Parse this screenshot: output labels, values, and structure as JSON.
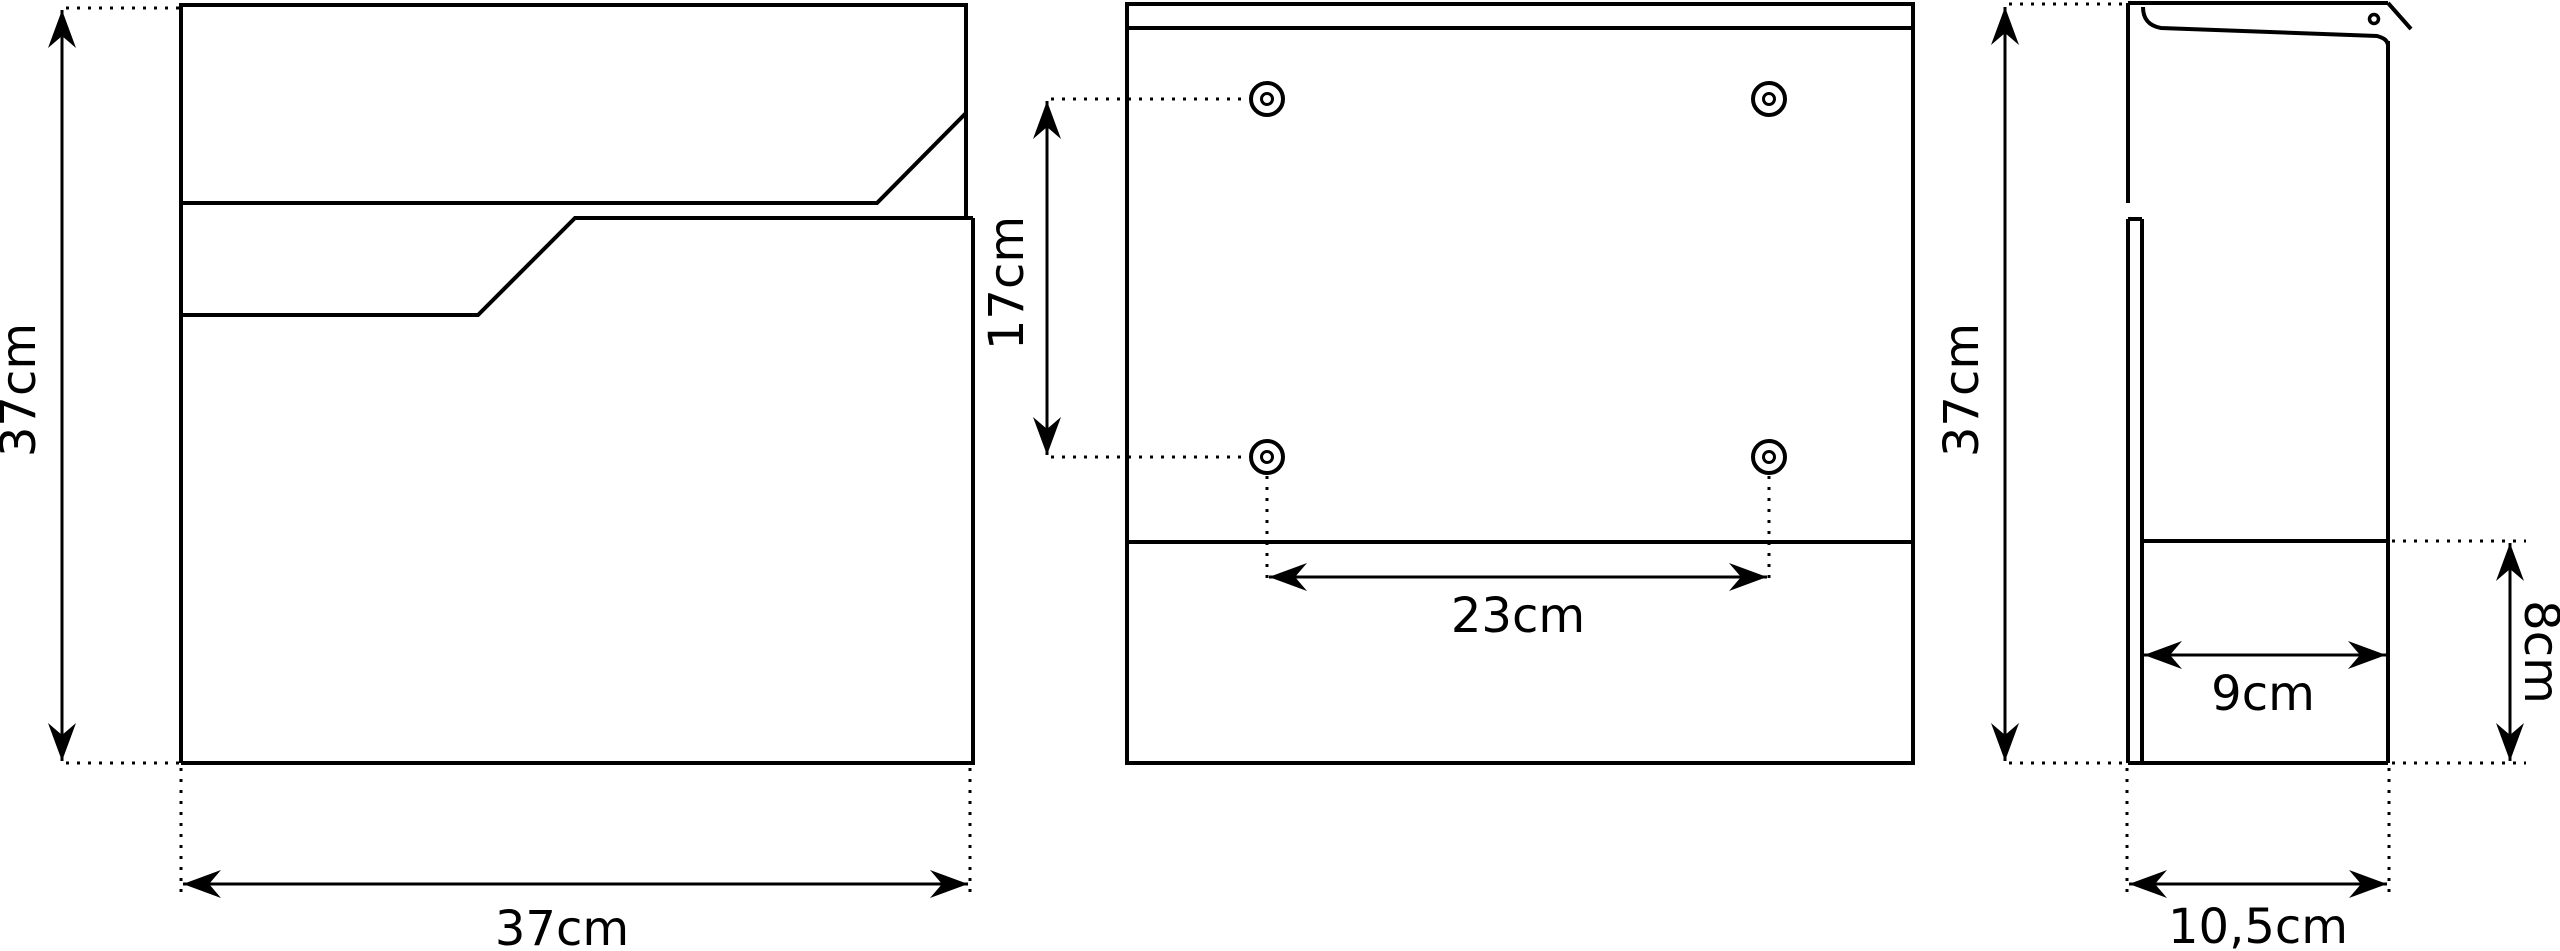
{
  "drawing": {
    "background": "#ffffff",
    "stroke_color": "#000000",
    "unit": "cm",
    "views": {
      "front_view": {
        "height_label": "37cm",
        "width_label": "37cm"
      },
      "back_view": {
        "hole_vertical_spacing_label": "17cm",
        "hole_horizontal_spacing_label": "23cm"
      },
      "side_view": {
        "height_label": "37cm",
        "inner_depth_label": "9cm",
        "lower_height_label": "8cm",
        "total_depth_label": "10,5cm"
      }
    }
  }
}
